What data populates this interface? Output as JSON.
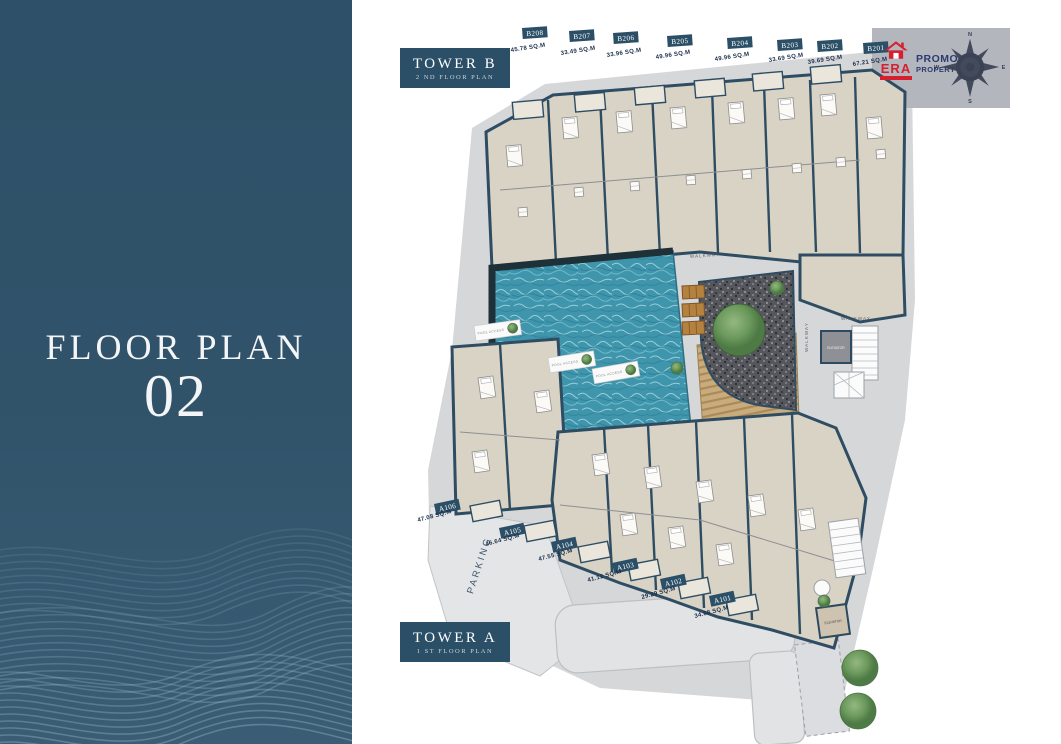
{
  "sidebar": {
    "title": "FLOOR PLAN",
    "number": "02"
  },
  "tower_b": {
    "name": "TOWER B",
    "subtitle": "2 ND FLOOR PLAN",
    "units": [
      {
        "id": "B208",
        "area": "45.78 SQ.M"
      },
      {
        "id": "B207",
        "area": "33.49 SQ.M"
      },
      {
        "id": "B206",
        "area": "33.96 SQ.M"
      },
      {
        "id": "B205",
        "area": "49.96 SQ.M"
      },
      {
        "id": "B204",
        "area": "49.96 SQ.M"
      },
      {
        "id": "B203",
        "area": "33.69 SQ.M"
      },
      {
        "id": "B202",
        "area": "39.69 SQ.M"
      },
      {
        "id": "B201",
        "area": "67.21 SQ.M"
      }
    ]
  },
  "tower_a": {
    "name": "TOWER A",
    "subtitle": "1 ST FLOOR PLAN",
    "units": [
      {
        "id": "A106",
        "area": "47.08 SQ.M"
      },
      {
        "id": "A105",
        "area": "46.64 SQ.M"
      },
      {
        "id": "A104",
        "area": "47.55 SQ.M"
      },
      {
        "id": "A103",
        "area": "41.12 SQ.M"
      },
      {
        "id": "A102",
        "area": "29.29 SQ.M"
      },
      {
        "id": "A101",
        "area": "34.68 SQ.M"
      }
    ]
  },
  "plan_labels": {
    "walkway": "WALKWAY",
    "elevator": "ELEVATOR",
    "parking": "PARKING",
    "pool_access": "POOL ACCESS"
  },
  "compass": {
    "n": "N",
    "e": "E",
    "s": "S",
    "w": "W"
  },
  "logo": {
    "era": "ERA",
    "line1": "PROMO",
    "line2": "PROPERTY"
  },
  "colors": {
    "sidebar": "#31536a",
    "label_box": "#2b4f66",
    "wall": "#2e4d63",
    "building_fill": "#d9d3c6",
    "ground": "#d6d7d9",
    "pool": "#3f95ac",
    "deck": "#c9ac7d",
    "accent_red": "#d6202f",
    "logo_navy": "#2c3a72"
  }
}
